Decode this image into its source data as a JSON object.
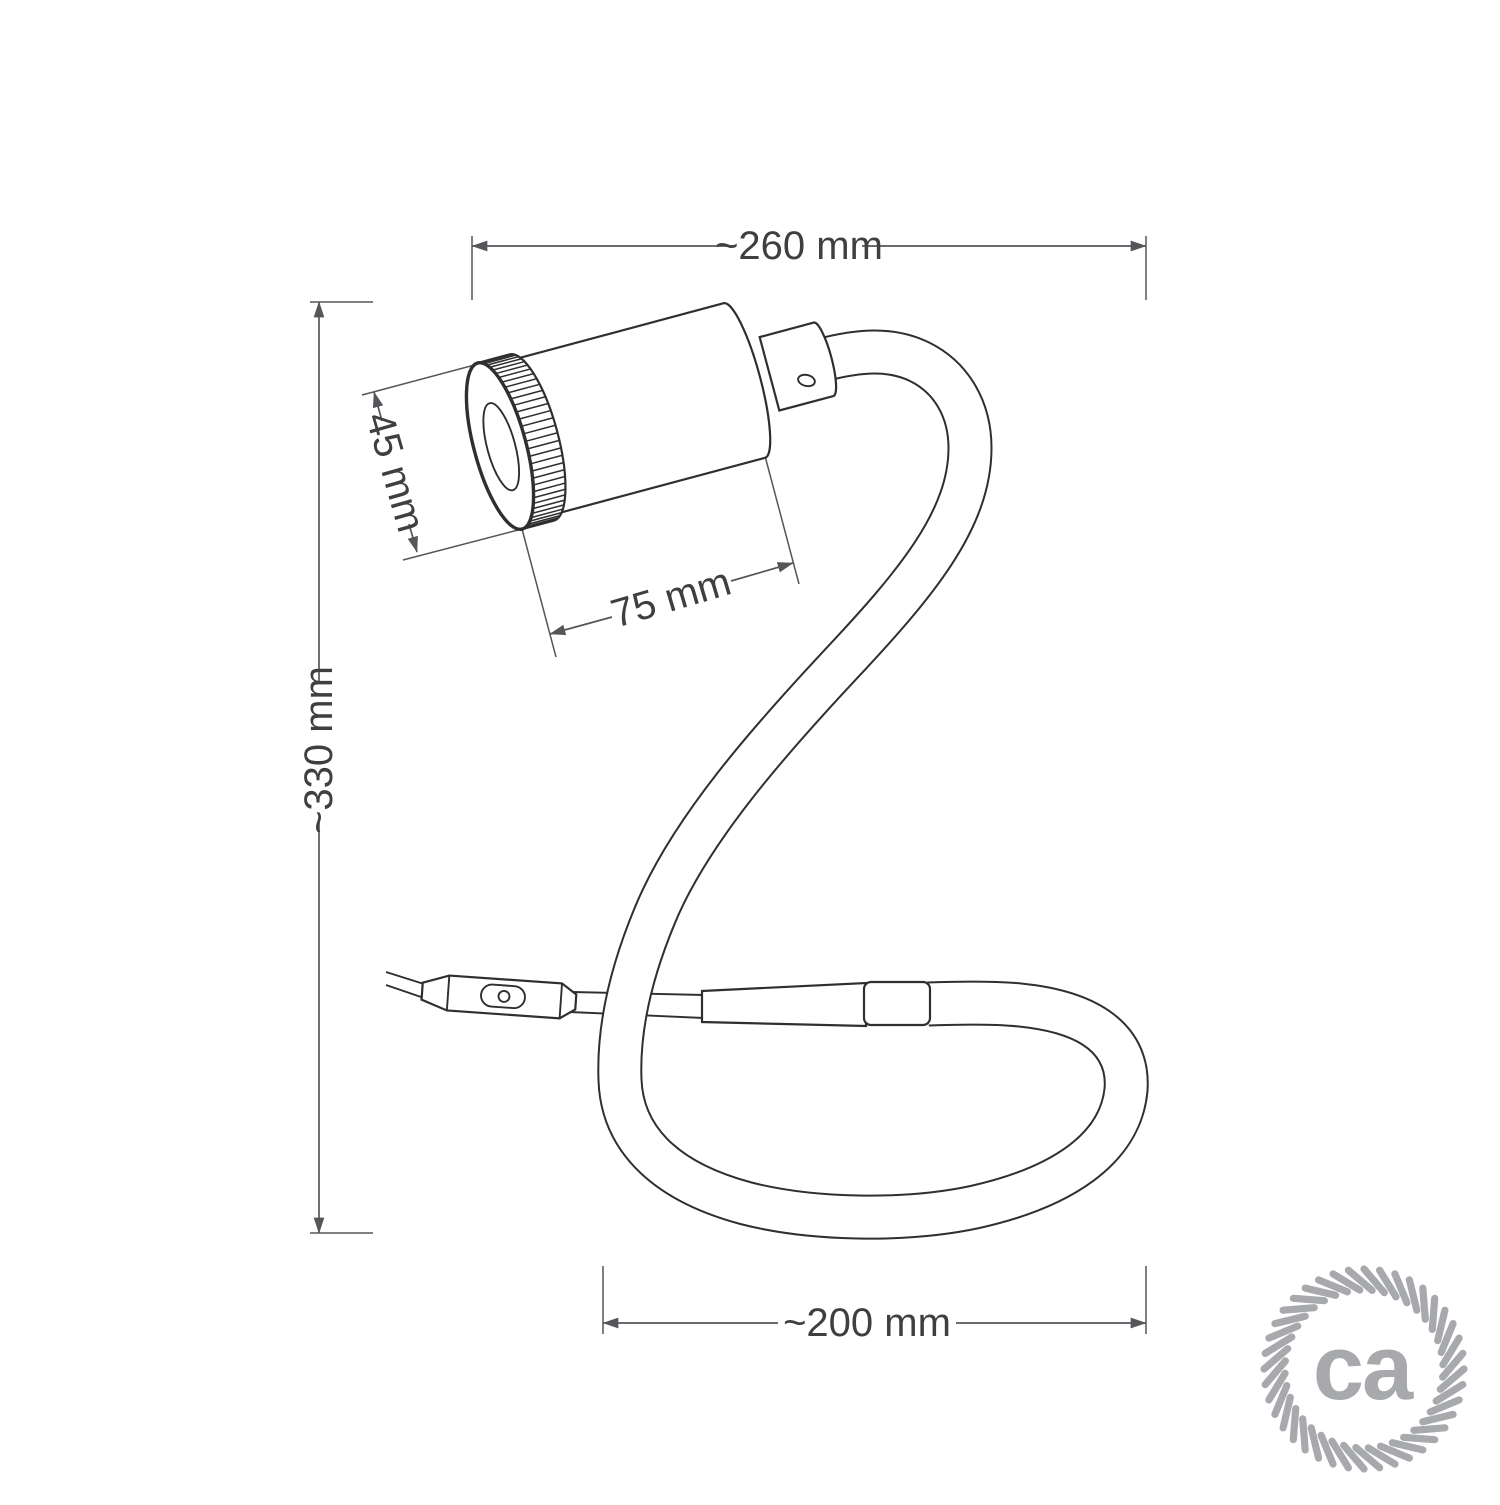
{
  "dims": {
    "top": "~260 mm",
    "left": "~330 mm",
    "diameter": "45 mm",
    "length": "75 mm",
    "bottom": "~200 mm"
  },
  "logo": {
    "text": "ca"
  },
  "colors": {
    "outline": "#2d2f31",
    "dimension": "#55565a",
    "label": "#3d3f41",
    "logo": "#a7a9ac",
    "background": "#ffffff"
  }
}
